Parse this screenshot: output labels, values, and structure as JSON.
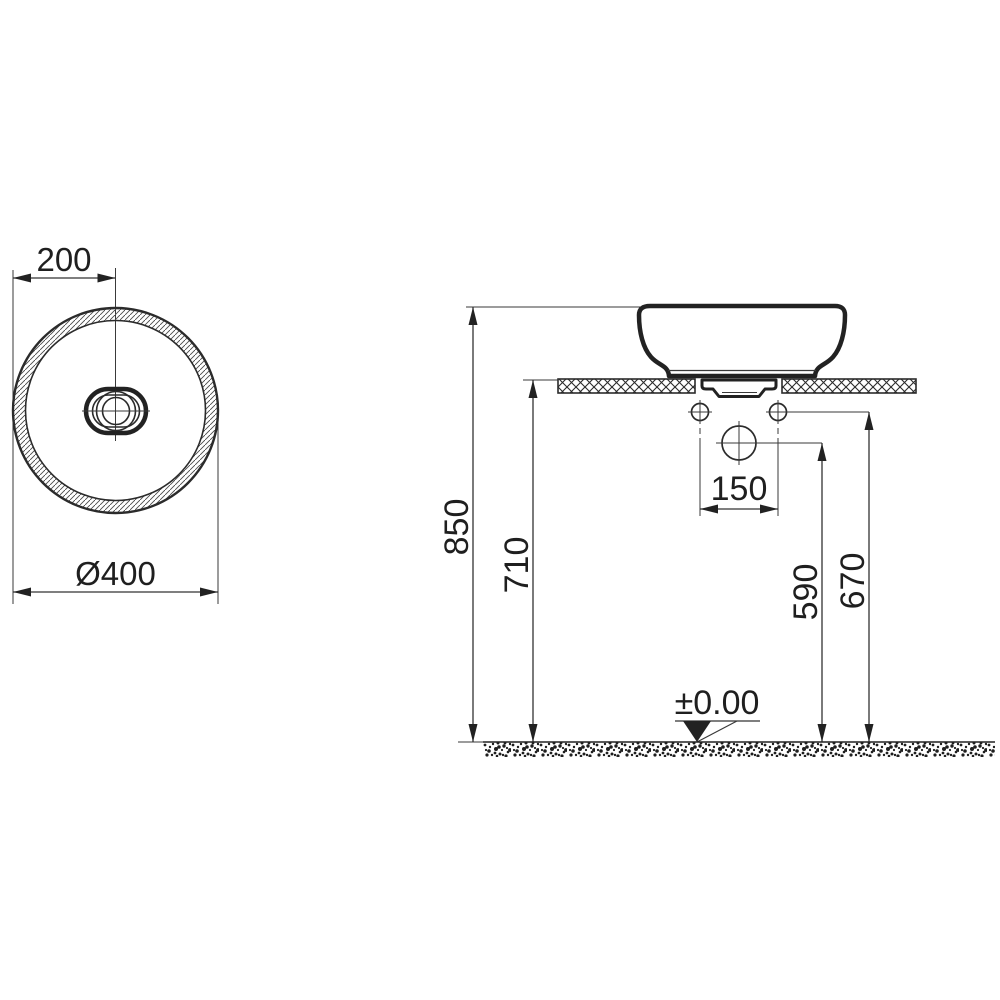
{
  "meta": {
    "drawing_type": "washbasin installation dimension drawing",
    "background_color": "#ffffff",
    "line_color": "#2b2b2b"
  },
  "top_view": {
    "description": "round countertop basin seen from above with oval drain",
    "center_offset_dim": "200",
    "diameter_dim": "Ø400"
  },
  "side_view": {
    "description": "basin on countertop, elevation with mounting heights",
    "total_height_dim": "850",
    "counter_height_dim": "710",
    "supply_height_dim": "590",
    "holes_height_dim": "670",
    "hole_spacing_dim": "150",
    "floor_datum": "±0.00"
  }
}
